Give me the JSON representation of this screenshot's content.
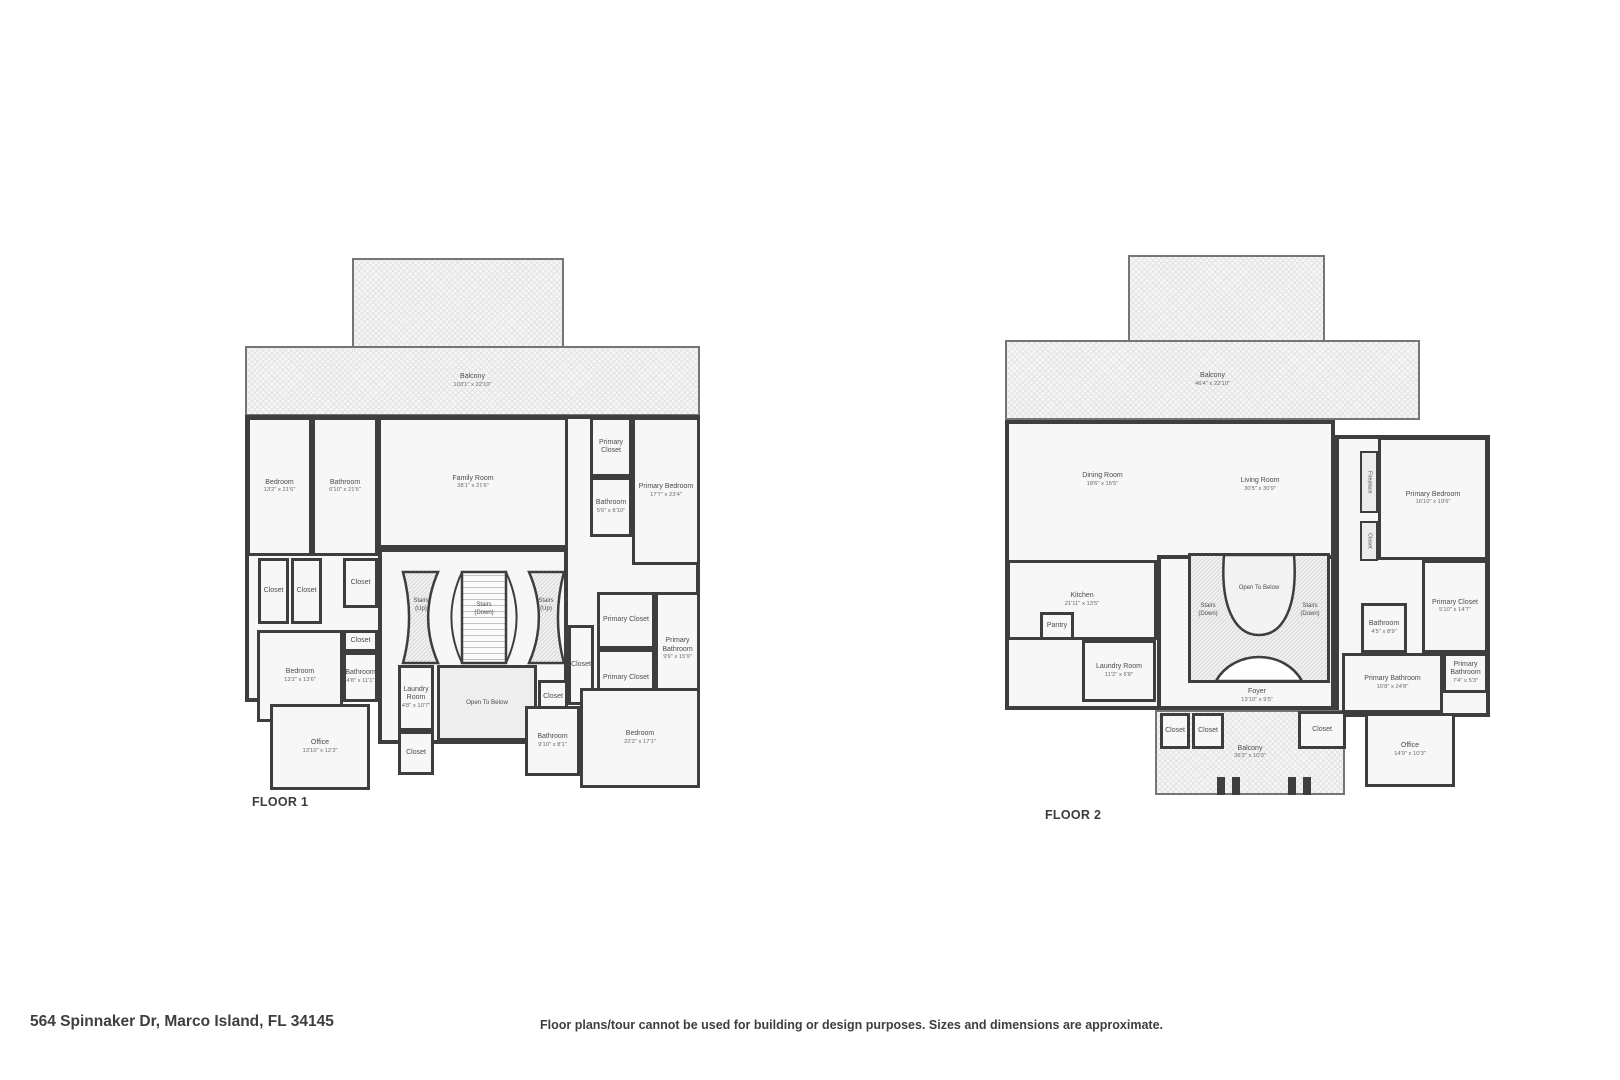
{
  "meta": {
    "address": "564 Spinnaker Dr, Marco Island, FL 34145",
    "disclaimer": "Floor plans/tour cannot be used for building or design purposes. Sizes and dimensions are approximate."
  },
  "colors": {
    "wall": "#3e3e3e",
    "room_fill": "#f7f7f7",
    "hatch_line": "#e3e3e3",
    "label_text": "#4c4c4c"
  },
  "floors": [
    {
      "id": "floor-1",
      "label": "FLOOR 1",
      "stairs": {
        "left": "Stairs\n(Up)",
        "center": "Stairs\n(Down)",
        "right": "Stairs\n(Up)"
      },
      "rooms": [
        {
          "id": "balcony-upper",
          "kind": "hatch-top",
          "x": 107,
          "y": 0,
          "w": 212,
          "h": 88
        },
        {
          "id": "balcony",
          "kind": "hatch",
          "x": 0,
          "y": 88,
          "w": 455,
          "h": 70,
          "name": "Balcony",
          "dims": "103'1\" x 22'10\""
        },
        {
          "id": "main-footprint",
          "kind": "base",
          "x": 0,
          "y": 157,
          "w": 455,
          "h": 287
        },
        {
          "id": "stair-hall",
          "kind": "base",
          "x": 133,
          "y": 290,
          "w": 190,
          "h": 196
        },
        {
          "id": "bedroom-1",
          "x": 2,
          "y": 159,
          "w": 65,
          "h": 139,
          "name": "Bedroom",
          "dims": "13'2\" x 21'6\""
        },
        {
          "id": "bathroom-1",
          "x": 67,
          "y": 159,
          "w": 66,
          "h": 139,
          "name": "Bathroom",
          "dims": "6'10\" x 21'6\""
        },
        {
          "id": "family-room",
          "x": 133,
          "y": 159,
          "w": 190,
          "h": 131,
          "name": "Family Room",
          "dims": "38'1\" x 21'6\""
        },
        {
          "id": "primary-closet-a",
          "x": 345,
          "y": 159,
          "w": 42,
          "h": 60,
          "name": "Primary Closet"
        },
        {
          "id": "bathroom-2",
          "x": 345,
          "y": 219,
          "w": 42,
          "h": 60,
          "name": "Bathroom",
          "dims": "5'6\" x 8'10\""
        },
        {
          "id": "primary-bedroom",
          "x": 387,
          "y": 159,
          "w": 68,
          "h": 148,
          "name": "Primary Bedroom",
          "dims": "17'7\" x 23'4\""
        },
        {
          "id": "closet-1",
          "x": 13,
          "y": 300,
          "w": 31,
          "h": 66,
          "name": "Closet"
        },
        {
          "id": "closet-2",
          "x": 46,
          "y": 300,
          "w": 31,
          "h": 66,
          "name": "Closet"
        },
        {
          "id": "closet-3",
          "x": 98,
          "y": 300,
          "w": 35,
          "h": 50,
          "name": "Closet"
        },
        {
          "id": "bedroom-2",
          "x": 12,
          "y": 372,
          "w": 86,
          "h": 92,
          "name": "Bedroom",
          "dims": "13'2\" x 13'6\""
        },
        {
          "id": "closet-4",
          "x": 98,
          "y": 372,
          "w": 35,
          "h": 22,
          "name": "Closet"
        },
        {
          "id": "bathroom-3",
          "x": 98,
          "y": 394,
          "w": 35,
          "h": 50,
          "name": "Bathroom",
          "dims": "4'8\" x 11'1\""
        },
        {
          "id": "office",
          "x": 25,
          "y": 446,
          "w": 100,
          "h": 86,
          "name": "Office",
          "dims": "13'10\" x 12'3\""
        },
        {
          "id": "laundry-room",
          "x": 153,
          "y": 407,
          "w": 36,
          "h": 66,
          "name": "Laundry Room",
          "dims": "4'8\" x 10'7\""
        },
        {
          "id": "closet-5",
          "x": 153,
          "y": 473,
          "w": 36,
          "h": 44,
          "name": "Closet"
        },
        {
          "id": "open-to-below",
          "kind": "open",
          "x": 192,
          "y": 407,
          "w": 100,
          "h": 76,
          "name": "Open To Below"
        },
        {
          "id": "closet-6",
          "x": 323,
          "y": 367,
          "w": 26,
          "h": 80,
          "name": "Closet"
        },
        {
          "id": "closet-7",
          "x": 293,
          "y": 422,
          "w": 30,
          "h": 34,
          "name": "Closet"
        },
        {
          "id": "primary-closet-b",
          "x": 352,
          "y": 334,
          "w": 58,
          "h": 57,
          "name": "Primary Closet"
        },
        {
          "id": "primary-closet-c",
          "x": 352,
          "y": 391,
          "w": 58,
          "h": 58,
          "name": "Primary Closet"
        },
        {
          "id": "primary-bathroom",
          "x": 410,
          "y": 334,
          "w": 45,
          "h": 115,
          "name": "Primary Bathroom",
          "dims": "9'9\" x 15'9\""
        },
        {
          "id": "bathroom-4",
          "x": 280,
          "y": 448,
          "w": 55,
          "h": 70,
          "name": "Bathroom",
          "dims": "9'10\" x 8'1\""
        },
        {
          "id": "bedroom-3",
          "x": 335,
          "y": 430,
          "w": 120,
          "h": 100,
          "name": "Bedroom",
          "dims": "22'2\" x 17'1\""
        }
      ]
    },
    {
      "id": "floor-2",
      "label": "FLOOR 2",
      "stairs": {
        "left": "Stairs\n(Down)",
        "center": "Open To Below",
        "right": "Stairs\n(Down)"
      },
      "rooms": [
        {
          "id": "balcony-upper",
          "kind": "hatch-top",
          "x": 123,
          "y": 0,
          "w": 197,
          "h": 85
        },
        {
          "id": "balcony",
          "kind": "hatch",
          "x": 0,
          "y": 85,
          "w": 415,
          "h": 80,
          "name": "Balcony",
          "dims": "46'4\" x 22'10\""
        },
        {
          "id": "left-footprint",
          "kind": "base",
          "x": 0,
          "y": 165,
          "w": 330,
          "h": 290
        },
        {
          "id": "right-footprint",
          "kind": "base",
          "x": 330,
          "y": 180,
          "w": 155,
          "h": 282
        },
        {
          "id": "stair-hall",
          "kind": "base",
          "x": 152,
          "y": 300,
          "w": 178,
          "h": 155
        },
        {
          "id": "dining-room",
          "kind": "label",
          "x": 10,
          "y": 170,
          "w": 175,
          "h": 110,
          "name": "Dining Room",
          "dims": "18'6\" x 15'5\""
        },
        {
          "id": "living-room",
          "kind": "label",
          "x": 150,
          "y": 170,
          "w": 210,
          "h": 120,
          "name": "Living Room",
          "dims": "30'5\" x 30'9\""
        },
        {
          "id": "kitchen",
          "x": 2,
          "y": 305,
          "w": 150,
          "h": 80,
          "name": "Kitchen",
          "dims": "21'11\" x 13'5\""
        },
        {
          "id": "pantry",
          "x": 35,
          "y": 357,
          "w": 34,
          "h": 28,
          "name": "Pantry"
        },
        {
          "id": "laundry-room",
          "x": 77,
          "y": 385,
          "w": 74,
          "h": 62,
          "name": "Laundry Room",
          "dims": "11'2\" x 6'8\""
        },
        {
          "id": "foyer",
          "kind": "label",
          "x": 192,
          "y": 428,
          "w": 120,
          "h": 26,
          "name": "Foyer",
          "dims": "13'10\" x 9'5\""
        },
        {
          "id": "balcony-lower",
          "kind": "hatch",
          "x": 150,
          "y": 455,
          "w": 190,
          "h": 85,
          "name": "Balcony",
          "dims": "36'2\" x 10'3\""
        },
        {
          "id": "closet-1",
          "x": 155,
          "y": 458,
          "w": 30,
          "h": 36,
          "name": "Closet"
        },
        {
          "id": "closet-2",
          "x": 187,
          "y": 458,
          "w": 32,
          "h": 36,
          "name": "Closet"
        },
        {
          "id": "closet-3",
          "x": 293,
          "y": 456,
          "w": 48,
          "h": 38,
          "name": "Closet"
        },
        {
          "id": "fireplace",
          "kind": "vlabel",
          "x": 355,
          "y": 196,
          "w": 18,
          "h": 62,
          "name": "Fireplace"
        },
        {
          "id": "closet-4",
          "kind": "vlabel",
          "x": 355,
          "y": 266,
          "w": 18,
          "h": 40,
          "name": "Closet"
        },
        {
          "id": "primary-bedroom",
          "x": 373,
          "y": 182,
          "w": 110,
          "h": 123,
          "name": "Primary Bedroom",
          "dims": "16'10\" x 19'6\""
        },
        {
          "id": "bathroom",
          "x": 356,
          "y": 348,
          "w": 46,
          "h": 50,
          "name": "Bathroom",
          "dims": "4'5\" x 8'9\""
        },
        {
          "id": "primary-closet",
          "x": 417,
          "y": 305,
          "w": 66,
          "h": 93,
          "name": "Primary Closet",
          "dims": "5'10\" x 14'7\""
        },
        {
          "id": "primary-bathroom",
          "x": 337,
          "y": 398,
          "w": 101,
          "h": 60,
          "name": "Primary Bathroom",
          "dims": "16'8\" x 24'8\""
        },
        {
          "id": "primary-bathroom-2",
          "x": 438,
          "y": 398,
          "w": 45,
          "h": 40,
          "name": "Primary Bathroom",
          "dims": "7'4\" x 5'3\""
        },
        {
          "id": "office",
          "x": 360,
          "y": 458,
          "w": 90,
          "h": 74,
          "name": "Office",
          "dims": "14'9\" x 10'3\""
        },
        {
          "id": "railing-post-1",
          "kind": "post",
          "x": 212,
          "y": 522,
          "w": 8,
          "h": 18
        },
        {
          "id": "railing-post-2",
          "kind": "post",
          "x": 227,
          "y": 522,
          "w": 8,
          "h": 18
        },
        {
          "id": "railing-post-3",
          "kind": "post",
          "x": 283,
          "y": 522,
          "w": 8,
          "h": 18
        },
        {
          "id": "railing-post-4",
          "kind": "post",
          "x": 298,
          "y": 522,
          "w": 8,
          "h": 18
        }
      ]
    }
  ]
}
